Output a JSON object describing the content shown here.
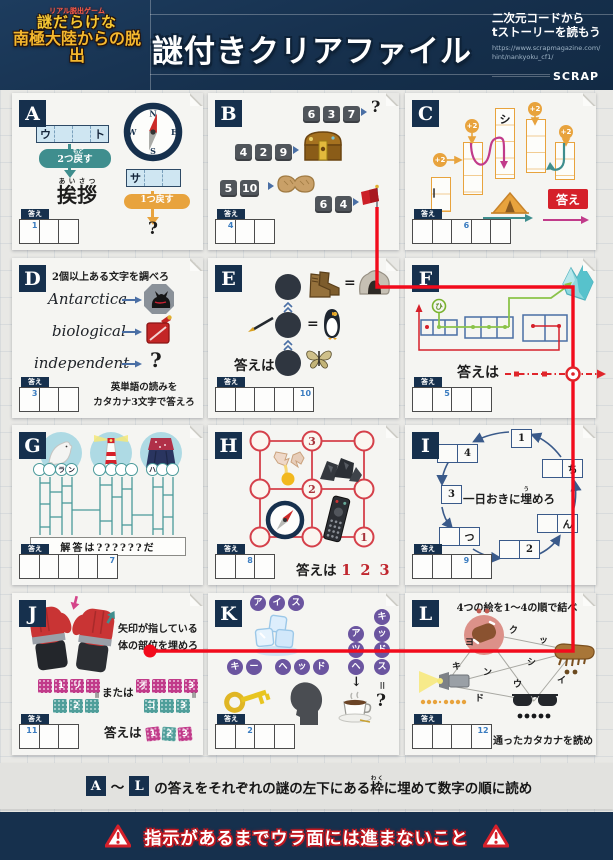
{
  "colors": {
    "navy": "#16304d",
    "red": "#d5202a",
    "route_red": "#f20b1c",
    "teal": "#3f8e8e",
    "orange": "#e8a33d",
    "magenta": "#c13b8a",
    "purple": "#6b55a0",
    "answer_num_blue": "#3a7cc0"
  },
  "answer_tab": "答え",
  "header": {
    "logo_small": "リアル脱出ゲーム",
    "logo_line1": "謎だらけな",
    "logo_line2": "南極大陸からの脱出",
    "title": "謎付きクリアファイル",
    "qr_line1": "二次元コードから",
    "qr_line2": "ストーリーを読もう",
    "url_line1": "https://www.scrapmagazine.com/",
    "url_line2": "hint/nankyoku_cf1/",
    "brand": "SCRAP"
  },
  "puzzles": {
    "A": {
      "label": "A",
      "word_first": "ウ",
      "word_last": "ト",
      "pill2_pre": "2つ",
      "pill2_kanji": "戻",
      "pill2_furi": "もど",
      "pill2_post": "す",
      "greeting": "挨拶",
      "greeting_furi": "あいさつ",
      "compass_n": "N",
      "compass_e": "E",
      "compass_s": "S",
      "compass_w": "W",
      "side_first": "サ",
      "pill1": "1つ戻す",
      "question": "?",
      "ans_num": "1"
    },
    "B": {
      "label": "B",
      "r1": [
        "6",
        "3",
        "7"
      ],
      "r1_q": "?",
      "r2": [
        "4",
        "2",
        "9"
      ],
      "r3": [
        "5",
        "10"
      ],
      "r4": [
        "6",
        "4"
      ],
      "ans_num": "4"
    },
    "C": {
      "label": "C",
      "shi": "シ",
      "chou": "ー",
      "plus2": "+2",
      "answer_chip": "答え",
      "ans_num": "6"
    },
    "D": {
      "label": "D",
      "title": "2個以上ある文字を調べろ",
      "word1": "Antarctica",
      "word2": "biological",
      "word3": "independent",
      "question": "?",
      "note1": "英単語の読みを",
      "note2": "カタカナ3文字で答えろ",
      "ans_num": "3"
    },
    "E": {
      "label": "E",
      "eq": "=",
      "answer_wa": "答えは",
      "ans_num": "10"
    },
    "F": {
      "label": "F",
      "hi": "ひ",
      "answer_wa": "答えは",
      "ans_num": "5"
    },
    "G": {
      "label": "G",
      "g1_3": "ラ",
      "g1_4": "ン",
      "g3_1": "ハ",
      "result": "解答は??????だ",
      "ans_num": "7"
    },
    "H": {
      "label": "H",
      "n_top": "3",
      "n_mid": "2",
      "n_bot": "1",
      "answer_pre": "答えは",
      "answer_nums": "1 2 3",
      "ans_num": "8"
    },
    "I": {
      "label": "I",
      "b1": "1",
      "b2": "2",
      "b3": "3",
      "b4": "4",
      "chi": "ち",
      "nn": "ん",
      "tsu": "つ",
      "center_pre": "一日おきに",
      "center_kanji": "埋",
      "center_furi": "う",
      "center_post": "めろ",
      "ans_num": "9"
    },
    "J": {
      "label": "J",
      "line1": "矢印が指している",
      "line2": "体の部位を埋めろ",
      "or": "または",
      "lt2": "1",
      "lt3": "リ",
      "lb2": "2",
      "rt1": "オ",
      "rt4": "3",
      "rb1": "コ",
      "rb3": "3",
      "eq": "=",
      "answer_pre": "答えは",
      "at1": "1",
      "at2": "2",
      "at3": "3",
      "ans_num": "11"
    },
    "K": {
      "label": "K",
      "ice": [
        "ア",
        "イ",
        "ス"
      ],
      "key": [
        "キ",
        "ー"
      ],
      "head": [
        "ヘ",
        "ッ",
        "ド"
      ],
      "col1": [
        "ア",
        "ツ",
        "ヘ"
      ],
      "col2": [
        "キ",
        "ッ",
        "ド",
        "ス"
      ],
      "down": "↓",
      "eq": "=",
      "question": "?",
      "ans_num": "2"
    },
    "L": {
      "label": "L",
      "title": "4つの絵を1〜4の順で結べ",
      "letters": [
        "ヨ",
        "ク",
        "ッ",
        "キ",
        "ン",
        "シ",
        "ウ",
        "イ",
        "ド"
      ],
      "bottom": "通ったカタカナを読め",
      "ans_num": "12"
    }
  },
  "bottom": {
    "box_a": "A",
    "tilde": "〜",
    "box_l": "L",
    "pre": "の答えをそれぞれの謎の左下にある",
    "waku": "枠",
    "waku_furi": "わく",
    "post": "に埋めて数字の順に読め"
  },
  "warning": "指示があるまでウラ面には進まないこと"
}
